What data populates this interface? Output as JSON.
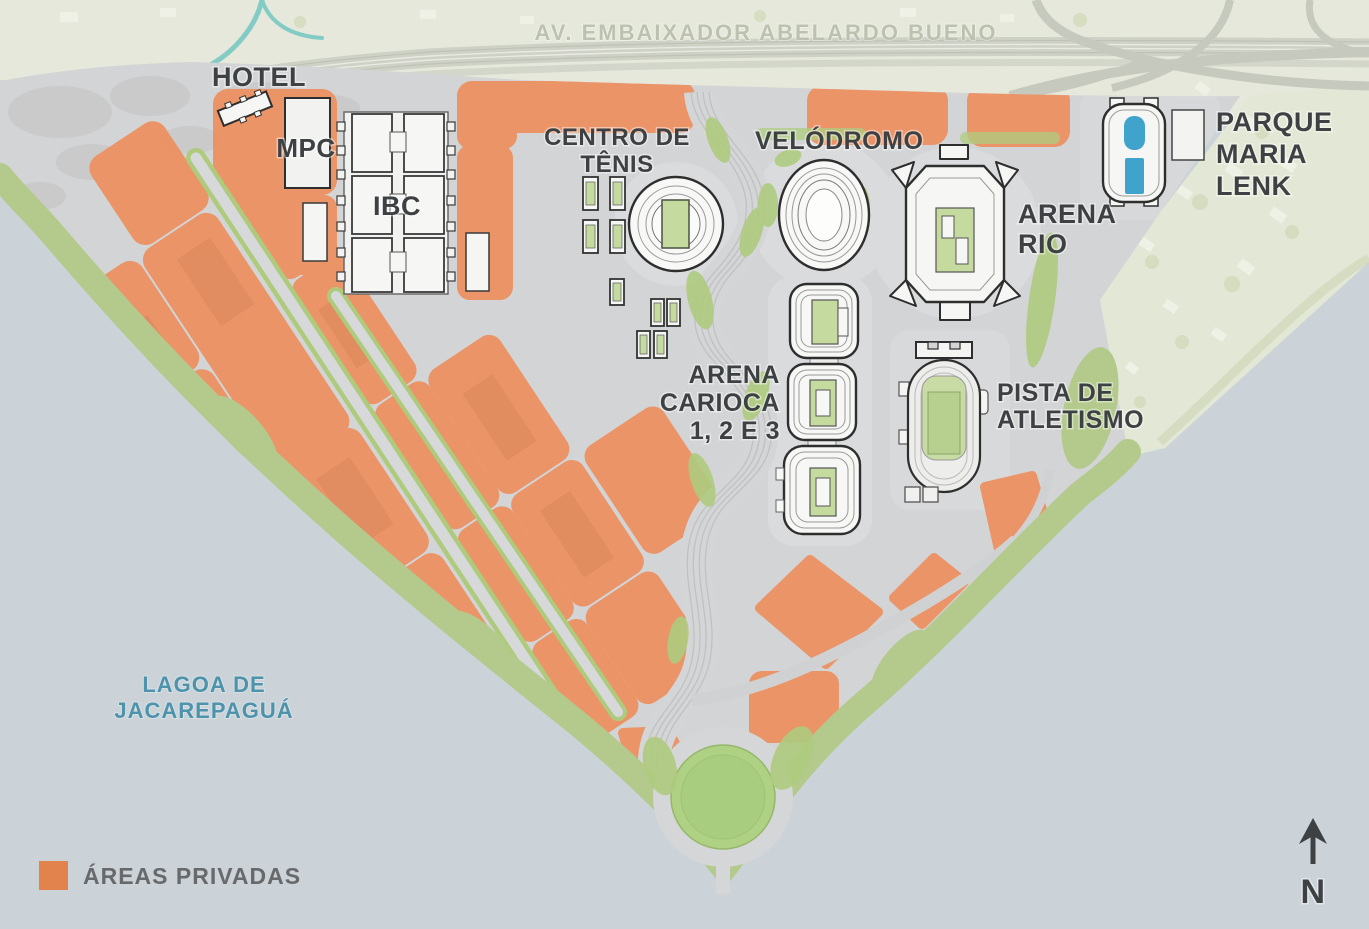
{
  "map": {
    "road_label": "AV. EMBAIXADOR ABELARDO BUENO",
    "water": {
      "line1": "LAGOA DE",
      "line2": "JACAREPAGUÁ"
    },
    "venues": {
      "hotel": "HOTEL",
      "mpc": "MPC",
      "ibc": "IBC",
      "tennis": {
        "line1": "CENTRO DE",
        "line2": "TÊNIS"
      },
      "velodrome": "VELÓDROMO",
      "arena_rio": {
        "line1": "ARENA",
        "line2": "RIO"
      },
      "parque_maria_lenk": {
        "line1": "PARQUE",
        "line2": "MARIA",
        "line3": "LENK"
      },
      "arena_carioca": {
        "line1": "ARENA",
        "line2": "CARIOCA",
        "line3": "1, 2 E 3"
      },
      "pista": {
        "line1": "PISTA DE",
        "line2": "ATLETISMO"
      }
    },
    "legend": {
      "areas_privadas": "ÁREAS PRIVADAS",
      "swatch_color": "#E2834E"
    },
    "compass": {
      "north": "N"
    },
    "colors": {
      "water": "#CBD3D9",
      "terrain": "#E5E8DA",
      "residential_band": "#E3E7D5",
      "park_gray": "#D3D4D5",
      "private_orange": "#EC9162",
      "vegetation_green": "#B3CA8C",
      "median_green": "#A9CB79",
      "court_green": "#C5DA9E",
      "pool_blue": "#3FA3CC",
      "stream_teal": "#83CCC5",
      "label_dark": "#3D4144",
      "label_water_blue": "#4D93AB"
    }
  }
}
